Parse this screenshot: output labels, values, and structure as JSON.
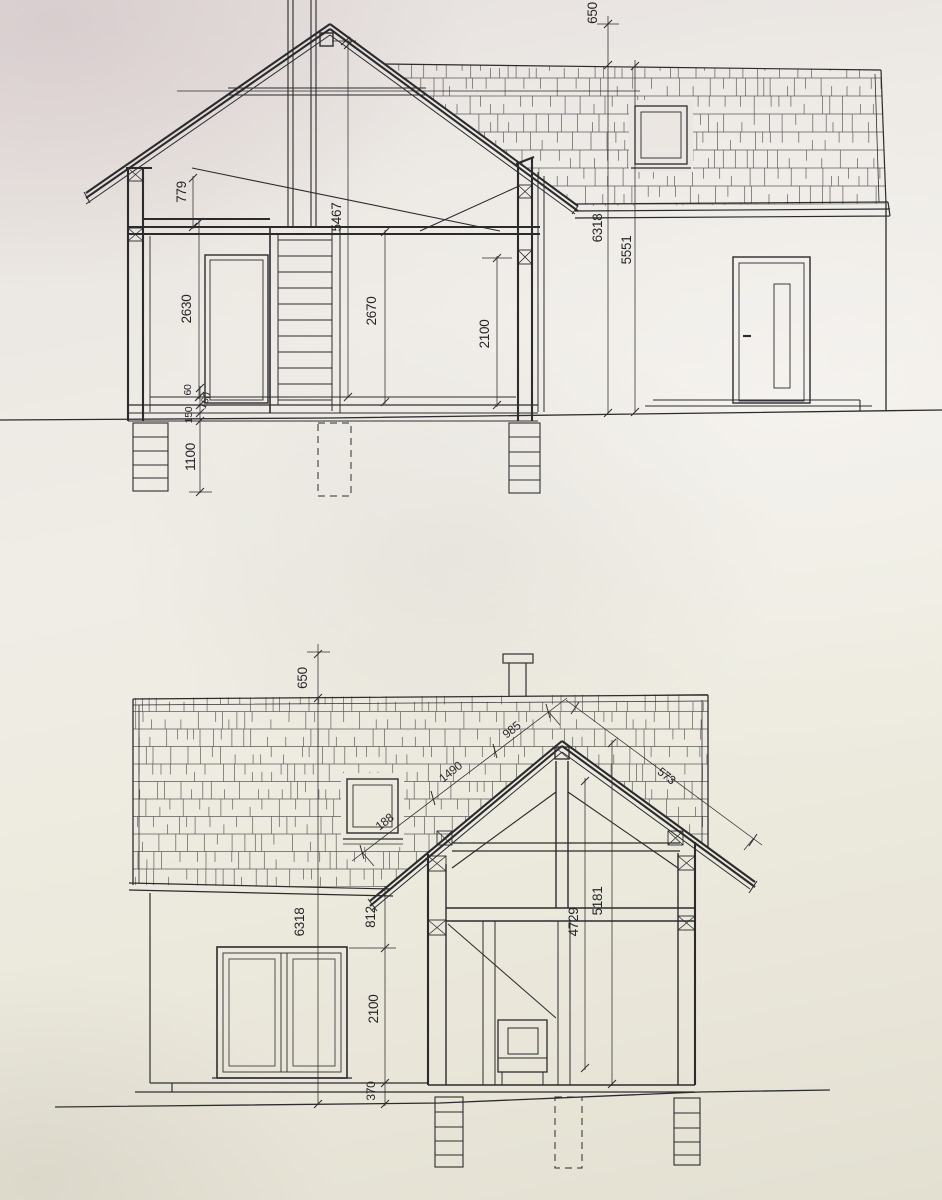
{
  "page": {
    "kind": "architectural blueprint photo",
    "sheet_color": "#ece9e0",
    "line_color": "#2b2b2e"
  },
  "top_drawing": {
    "title": "cross-section with side elevation",
    "dims": {
      "t650": "650",
      "t6318": "6318",
      "t5551": "5551",
      "t5467": "5467",
      "t779": "779",
      "t2630": "2630",
      "t2670": "2670",
      "t2100": "2100",
      "t60": "60",
      "t160": "160",
      "t150": "150",
      "t1100": "1100"
    }
  },
  "bottom_drawing": {
    "title": "front elevation with cross-section",
    "dims": {
      "b650": "650",
      "b6318": "6318",
      "b812": "812",
      "b2100": "2100",
      "b370": "370",
      "b4729": "4729",
      "b5181": "5181",
      "b188": "188",
      "b1490": "1490",
      "b985": "985",
      "b573": "573"
    }
  }
}
